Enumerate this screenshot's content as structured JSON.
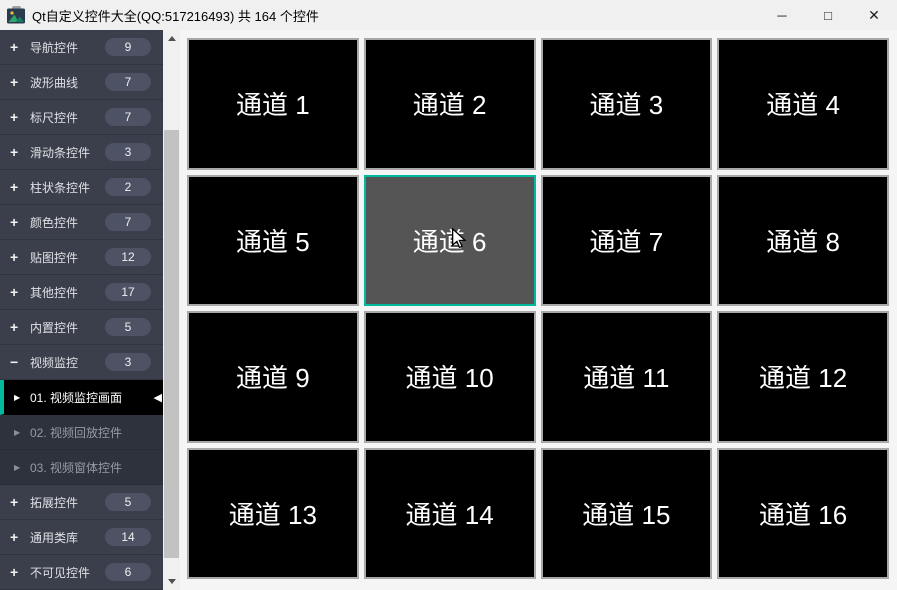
{
  "window": {
    "title": "Qt自定义控件大全(QQ:517216493) 共 164 个控件",
    "minimize_icon": "─",
    "maximize_icon": "□",
    "close_icon": "✕"
  },
  "colors": {
    "accent_teal": "#00ba9d",
    "sidebar_bg": "#3a3f4b",
    "sidebar_child_bg": "#2d323c",
    "sidebar_selected_bg": "#000000",
    "badge_bg": "#4d5365",
    "titlebar_bg": "#f0f0f0",
    "main_bg": "#f5f5f5",
    "cell_bg": "#000000",
    "cell_selected_bg": "#555555",
    "cell_border": "#a8a8a8"
  },
  "sidebar": {
    "child_arrow_icon": "▶",
    "selected_marker_icon": "◀",
    "groups": [
      {
        "icon": "+",
        "label": "导航控件",
        "count": "9"
      },
      {
        "icon": "+",
        "label": "波形曲线",
        "count": "7"
      },
      {
        "icon": "+",
        "label": "标尺控件",
        "count": "7"
      },
      {
        "icon": "+",
        "label": "滑动条控件",
        "count": "3"
      },
      {
        "icon": "+",
        "label": "柱状条控件",
        "count": "2"
      },
      {
        "icon": "+",
        "label": "颜色控件",
        "count": "7"
      },
      {
        "icon": "+",
        "label": "贴图控件",
        "count": "12"
      },
      {
        "icon": "+",
        "label": "其他控件",
        "count": "17"
      },
      {
        "icon": "+",
        "label": "内置控件",
        "count": "5"
      },
      {
        "icon": "−",
        "label": "视频监控",
        "count": "3"
      },
      {
        "icon": "+",
        "label": "拓展控件",
        "count": "5"
      },
      {
        "icon": "+",
        "label": "通用类库",
        "count": "14"
      },
      {
        "icon": "+",
        "label": "不可见控件",
        "count": "6"
      }
    ],
    "children": [
      {
        "label": "01. 视频监控画面",
        "selected": true
      },
      {
        "label": "02. 视频回放控件",
        "selected": false
      },
      {
        "label": "03. 视频窗体控件",
        "selected": false
      }
    ]
  },
  "grid": {
    "selected_channel": "通道 6",
    "channels": [
      "通道 1",
      "通道 2",
      "通道 3",
      "通道 4",
      "通道 5",
      "通道 6",
      "通道 7",
      "通道 8",
      "通道 9",
      "通道 10",
      "通道 11",
      "通道 12",
      "通道 13",
      "通道 14",
      "通道 15",
      "通道 16"
    ]
  }
}
